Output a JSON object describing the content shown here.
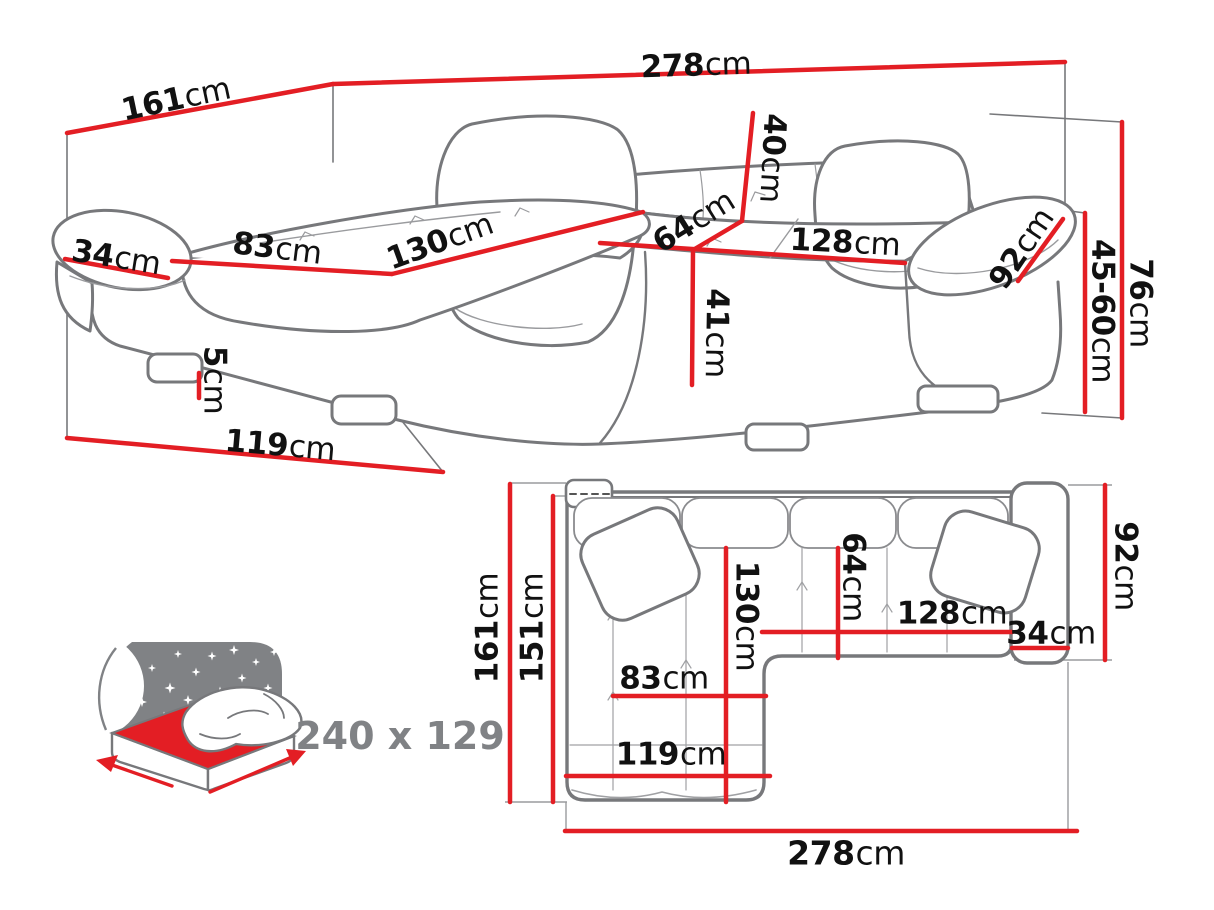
{
  "diagram_title": "corner sofa dimensions diagram",
  "colors": {
    "dimension_line": "#e31e24",
    "sketch_outline": "#77787b",
    "label_text": "#111111",
    "icon_gray": "#808285"
  },
  "perspective_view": {
    "name": "corner sofa perspective view",
    "labels": {
      "total_width": {
        "value": "278",
        "unit": "cm"
      },
      "total_depth": {
        "value": "161",
        "unit": "cm"
      },
      "armrest_width": {
        "value": "34",
        "unit": "cm"
      },
      "chaise_cushion_width": {
        "value": "83",
        "unit": "cm"
      },
      "chaise_length": {
        "value": "130",
        "unit": "cm"
      },
      "backrest_height": {
        "value": "40",
        "unit": "cm"
      },
      "seat_depth": {
        "value": "64",
        "unit": "cm"
      },
      "seat_width": {
        "value": "128",
        "unit": "cm"
      },
      "armrest_length": {
        "value": "92",
        "unit": "cm"
      },
      "total_height": {
        "value": "76",
        "unit": "cm"
      },
      "armrest_height": {
        "value": "45-60",
        "unit": "cm"
      },
      "seat_height": {
        "value": "41",
        "unit": "cm"
      },
      "leg_height": {
        "value": "5",
        "unit": "cm"
      },
      "chaise_width": {
        "value": "119",
        "unit": "cm"
      }
    }
  },
  "plan_view": {
    "name": "corner sofa top view",
    "labels": {
      "total_depth": {
        "value": "161",
        "unit": "cm"
      },
      "inner_depth": {
        "value": "151",
        "unit": "cm"
      },
      "chaise_length": {
        "value": "130",
        "unit": "cm"
      },
      "seat_depth": {
        "value": "64",
        "unit": "cm"
      },
      "seat_width": {
        "value": "128",
        "unit": "cm"
      },
      "armrest_width": {
        "value": "34",
        "unit": "cm"
      },
      "armrest_length": {
        "value": "92",
        "unit": "cm"
      },
      "chaise_cushion_width": {
        "value": "83",
        "unit": "cm"
      },
      "chaise_width": {
        "value": "119",
        "unit": "cm"
      },
      "total_width": {
        "value": "278",
        "unit": "cm"
      }
    }
  },
  "sleeping_area": {
    "label": "240 x 129"
  }
}
